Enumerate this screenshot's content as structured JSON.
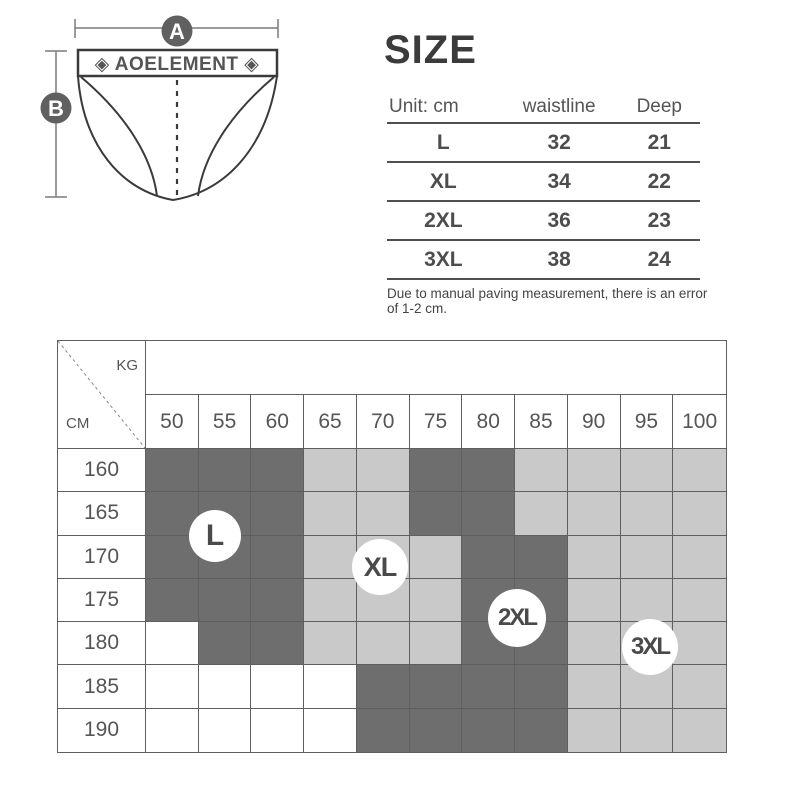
{
  "diagram": {
    "band_text": "◈ AOELEMENT ◈",
    "dim_a": "A",
    "dim_b": "B"
  },
  "size_panel": {
    "title": "SIZE",
    "table": {
      "headers": [
        "Unit: cm",
        "waistline",
        "Deep"
      ],
      "rows": [
        {
          "size": "L",
          "waistline": "32",
          "deep": "21"
        },
        {
          "size": "XL",
          "waistline": "34",
          "deep": "22"
        },
        {
          "size": "2XL",
          "waistline": "36",
          "deep": "23"
        },
        {
          "size": "3XL",
          "waistline": "38",
          "deep": "24"
        }
      ]
    },
    "note": "Due to manual paving measurement, there is an error of 1-2 cm."
  },
  "chart_data": {
    "type": "heatmap",
    "x_label": "KG",
    "y_label": "CM",
    "x_ticks": [
      "50",
      "55",
      "60",
      "65",
      "70",
      "75",
      "80",
      "85",
      "90",
      "95",
      "100"
    ],
    "y_ticks": [
      "160",
      "165",
      "170",
      "175",
      "180",
      "185",
      "190"
    ],
    "cells": [
      [
        "D",
        "D",
        "D",
        "G",
        "G",
        "D",
        "D",
        "G",
        "G",
        "G",
        "G"
      ],
      [
        "D",
        "D",
        "D",
        "G",
        "G",
        "D",
        "D",
        "G",
        "G",
        "G",
        "G"
      ],
      [
        "D",
        "D",
        "D",
        "G",
        "G",
        "G",
        "D",
        "D",
        "G",
        "G",
        "G"
      ],
      [
        "D",
        "D",
        "D",
        "G",
        "G",
        "G",
        "D",
        "D",
        "G",
        "G",
        "G"
      ],
      [
        "W",
        "D",
        "D",
        "G",
        "G",
        "G",
        "D",
        "D",
        "G",
        "G",
        "G"
      ],
      [
        "W",
        "W",
        "W",
        "W",
        "D",
        "D",
        "D",
        "D",
        "G",
        "G",
        "G"
      ],
      [
        "W",
        "W",
        "W",
        "W",
        "D",
        "D",
        "D",
        "D",
        "G",
        "G",
        "G"
      ]
    ],
    "cell_colors": {
      "D": "#6e6e6e",
      "G": "#c9c9c9",
      "W": "#ffffff"
    },
    "size_markers": [
      {
        "label": "L",
        "at_kg": "55",
        "at_cm": "165-170"
      },
      {
        "label": "XL",
        "at_kg": "70",
        "at_cm": "170-175"
      },
      {
        "label": "2XL",
        "at_kg": "80-85",
        "at_cm": "175-180"
      },
      {
        "label": "3XL",
        "at_kg": "95",
        "at_cm": "180"
      }
    ]
  },
  "colors": {
    "dark_cell": "#6e6e6e",
    "light_cell": "#c9c9c9",
    "white_cell": "#ffffff",
    "grid_border": "#5f5f5f",
    "line_art": "#3a3a3a",
    "dim_circle": "#606060",
    "text": "#555555"
  }
}
